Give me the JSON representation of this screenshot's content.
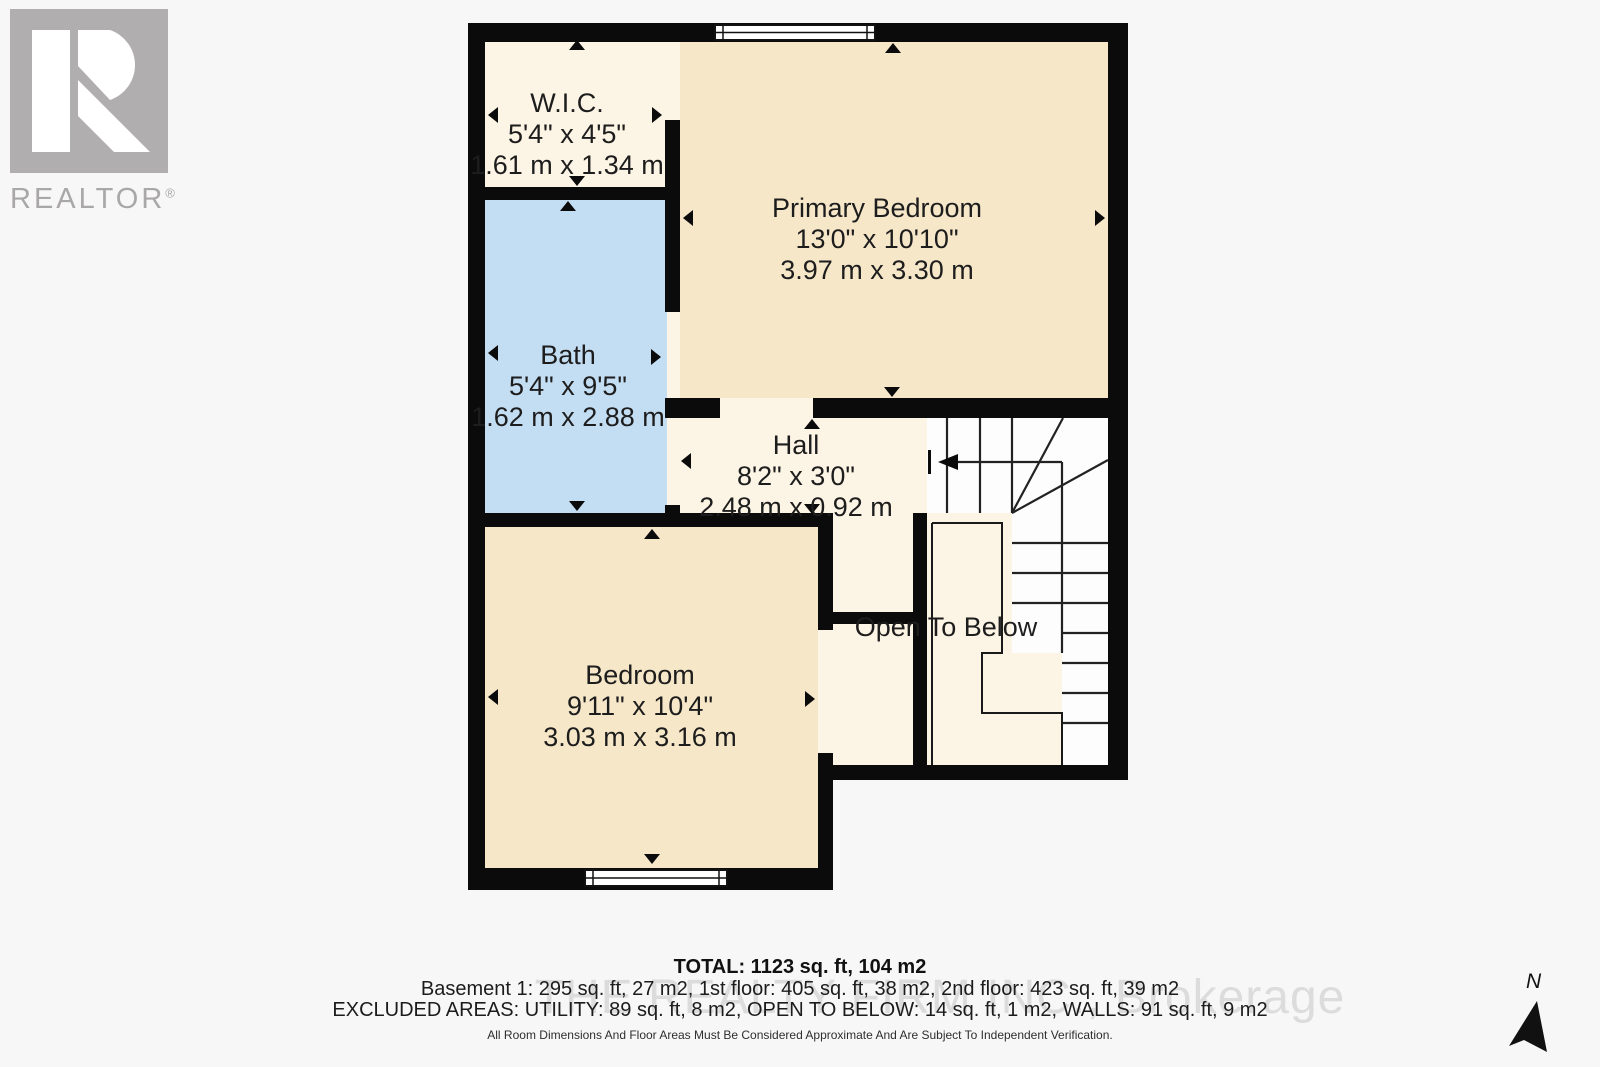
{
  "branding": {
    "logo_text": "REALTOR",
    "registered": "®"
  },
  "rooms": {
    "wic": {
      "name": "W.I.C.",
      "imperial": "5'4\" x 4'5\"",
      "metric": "1.61 m x 1.34 m"
    },
    "bath": {
      "name": "Bath",
      "imperial": "5'4\" x 9'5\"",
      "metric": "1.62 m x 2.88 m"
    },
    "primary_bedroom": {
      "name": "Primary Bedroom",
      "imperial": "13'0\" x 10'10\"",
      "metric": "3.97 m x 3.30 m"
    },
    "hall": {
      "name": "Hall",
      "imperial": "8'2\" x 3'0\"",
      "metric": "2.48 m x 0.92 m"
    },
    "bedroom": {
      "name": "Bedroom",
      "imperial": "9'11\" x 10'4\"",
      "metric": "3.03 m x 3.16 m"
    },
    "open_to_below": {
      "name": "Open To Below"
    }
  },
  "compass": {
    "north_label": "N"
  },
  "footer": {
    "total": "TOTAL: 1123 sq. ft, 104 m2",
    "floors": "Basement 1: 295 sq. ft, 27 m2, 1st floor: 405 sq. ft, 38 m2, 2nd floor: 423 sq. ft, 39 m2",
    "excluded": "EXCLUDED AREAS: UTILITY: 89 sq. ft, 8 m2, OPEN TO BELOW: 14 sq. ft, 1 m2, WALLS: 91 sq. ft, 9 m2",
    "disclaimer": "All Room Dimensions And Floor Areas Must Be Considered Approximate And Are Subject To Independent Verification.",
    "watermark": "THE REALTY FIRM INC., Brokerage"
  },
  "colors": {
    "wall": "#0b0b0b",
    "cream": "#fcf4e4",
    "tan": "#f6e7c9",
    "bath_blue": "#c3ddf3",
    "stair_white": "#fdfdfd",
    "background": "#f7f7f7",
    "logo_gray": "#b0aeae"
  }
}
